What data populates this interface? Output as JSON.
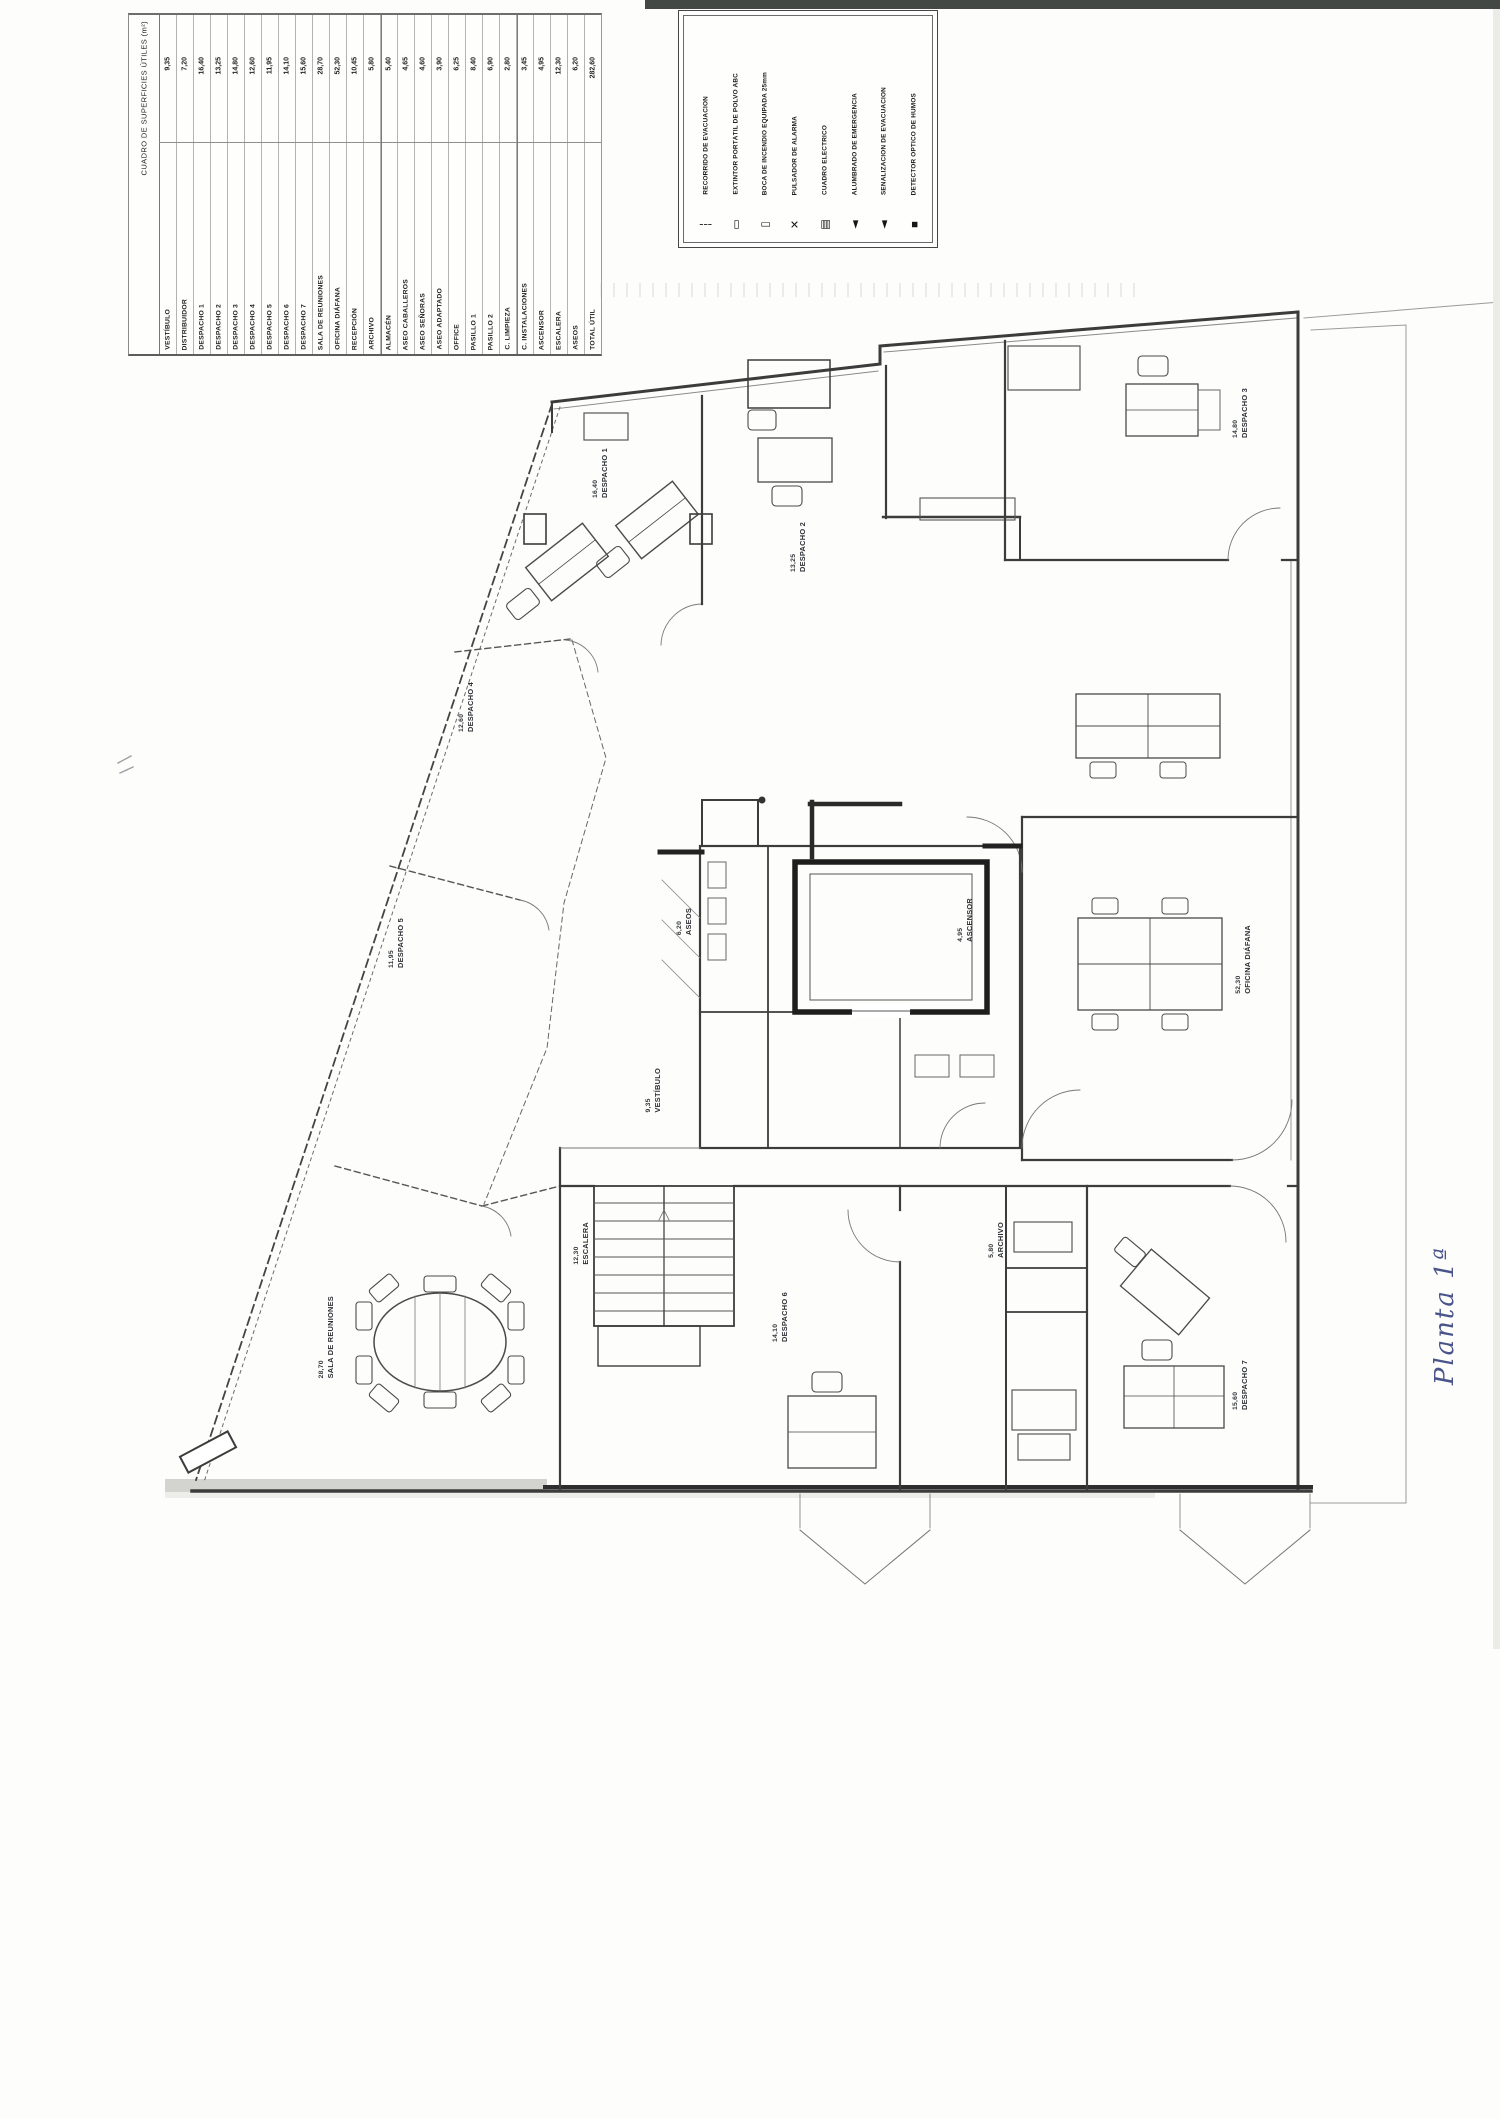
{
  "document": {
    "kind": "scanned architectural floor plan",
    "handwritten_note": "Planta 1ª",
    "ink_color": "#49548a",
    "paper_color": "#fdfdfb"
  },
  "area_table": {
    "title": "CUADRO DE SUPERFICIES ÚTILES (m²)",
    "rows": [
      {
        "name": "VESTÍBULO",
        "area": "9,35"
      },
      {
        "name": "DISTRIBUIDOR",
        "area": "7,20"
      },
      {
        "name": "DESPACHO 1",
        "area": "16,40"
      },
      {
        "name": "DESPACHO 2",
        "area": "13,25"
      },
      {
        "name": "DESPACHO 3",
        "area": "14,80"
      },
      {
        "name": "DESPACHO 4",
        "area": "12,60"
      },
      {
        "name": "DESPACHO 5",
        "area": "11,95"
      },
      {
        "name": "DESPACHO 6",
        "area": "14,10"
      },
      {
        "name": "DESPACHO 7",
        "area": "15,60"
      },
      {
        "name": "SALA DE REUNIONES",
        "area": "28,70"
      },
      {
        "name": "OFICINA DIÁFANA",
        "area": "52,30"
      },
      {
        "name": "RECEPCIÓN",
        "area": "10,45"
      },
      {
        "name": "ARCHIVO",
        "area": "5,80"
      },
      {
        "name": "ALMACÉN",
        "area": "5,40"
      },
      {
        "name": "ASEO CABALLEROS",
        "area": "4,65"
      },
      {
        "name": "ASEO SEÑORAS",
        "area": "4,60"
      },
      {
        "name": "ASEO ADAPTADO",
        "area": "3,90"
      },
      {
        "name": "OFFICE",
        "area": "6,25"
      },
      {
        "name": "PASILLO 1",
        "area": "8,40"
      },
      {
        "name": "PASILLO 2",
        "area": "6,90"
      },
      {
        "name": "C. LIMPIEZA",
        "area": "2,80"
      },
      {
        "name": "C. INSTALACIONES",
        "area": "3,45"
      },
      {
        "name": "ASCENSOR",
        "area": "4,95"
      },
      {
        "name": "ESCALERA",
        "area": "12,30"
      },
      {
        "name": "ASEOS",
        "area": "6,20"
      },
      {
        "name": "TOTAL ÚTIL",
        "area": "282,60"
      }
    ]
  },
  "legend": {
    "entries": [
      {
        "symbol": "┆",
        "label": "RECORRIDO DE EVACUACIÓN"
      },
      {
        "symbol": "▭",
        "label": "EXTINTOR PORTÁTIL DE POLVO ABC"
      },
      {
        "symbol": "▯",
        "label": "BOCA DE INCENDIO EQUIPADA 25mm"
      },
      {
        "symbol": "✕",
        "label": "PULSADOR DE ALARMA"
      },
      {
        "symbol": "▤",
        "label": "CUADRO ELÉCTRICO"
      },
      {
        "symbol": "◄",
        "label": "ALUMBRADO DE EMERGENCIA"
      },
      {
        "symbol": "◄",
        "label": "SEÑALIZACIÓN DE EVACUACIÓN"
      },
      {
        "symbol": "▪",
        "label": "DETECTOR ÓPTICO DE HUMOS"
      }
    ]
  },
  "plan": {
    "labels": [
      {
        "x": 592,
        "y": 448,
        "name": "DESPACHO 1",
        "area": "16,40"
      },
      {
        "x": 790,
        "y": 522,
        "name": "DESPACHO 2",
        "area": "13,25"
      },
      {
        "x": 1232,
        "y": 388,
        "name": "DESPACHO 3",
        "area": "14,80"
      },
      {
        "x": 458,
        "y": 682,
        "name": "DESPACHO 4",
        "area": "12,60"
      },
      {
        "x": 388,
        "y": 918,
        "name": "DESPACHO 5",
        "area": "11,95"
      },
      {
        "x": 318,
        "y": 1296,
        "name": "SALA DE REUNIONES",
        "area": "28,70"
      },
      {
        "x": 676,
        "y": 908,
        "name": "ASEOS",
        "area": "6,20"
      },
      {
        "x": 957,
        "y": 898,
        "name": "ASCENSOR",
        "area": "4,95"
      },
      {
        "x": 645,
        "y": 1068,
        "name": "VESTÍBULO",
        "area": "9,35"
      },
      {
        "x": 772,
        "y": 1292,
        "name": "DESPACHO 6",
        "area": "14,10"
      },
      {
        "x": 988,
        "y": 1222,
        "name": "ARCHIVO",
        "area": "5,80"
      },
      {
        "x": 1232,
        "y": 1360,
        "name": "DESPACHO 7",
        "area": "15,60"
      },
      {
        "x": 1235,
        "y": 925,
        "name": "OFICINA DIÁFANA",
        "area": "52,30"
      },
      {
        "x": 573,
        "y": 1222,
        "name": "ESCALERA",
        "area": "12,30"
      }
    ]
  }
}
